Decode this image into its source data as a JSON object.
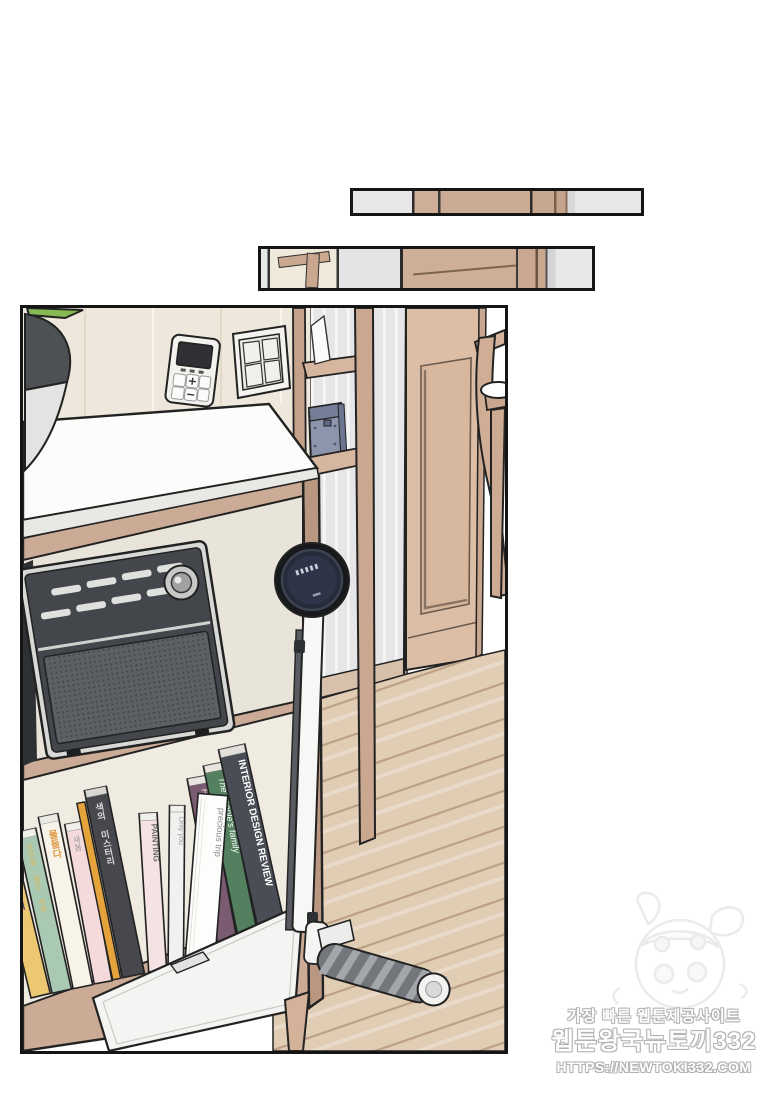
{
  "scene": {
    "type": "webtoon-episode-panel",
    "panel_count": 3,
    "objects": [
      "plant-pot",
      "thermostat",
      "light-switch",
      "white-countertop",
      "wood-cabinet",
      "vintage-radio",
      "book-row",
      "drawer",
      "cabinet-leg",
      "cordless-stick-vacuum",
      "ladder-shelf",
      "blue-toolbox",
      "paneled-wall",
      "wooden-door",
      "wooden-chair",
      "wood-plank-floor"
    ]
  },
  "books": [
    {
      "title": "국어의 정석",
      "spine_color": "#ecc873",
      "text_color": "#43436b"
    },
    {
      "title": "모두를 품은 하루",
      "spine_color": "#a9c9b3",
      "text_color": "#dcb85e"
    },
    {
      "title": "물들다",
      "spine_color": "#f7f3e9",
      "text_color": "#e09a46"
    },
    {
      "title": "새봄",
      "spine_color": "#f4dadb",
      "text_color": "#9a9aa0"
    },
    {
      "title": "색의 미스터리",
      "spine_color": "#46484e",
      "text_color": "#d9d9d9"
    },
    {
      "title": "PAINTING",
      "spine_color": "#f5e3e3",
      "text_color": "#6b6b6b"
    },
    {
      "title": "Only you",
      "spine_color": "#f1f1ef",
      "text_color": "#9a9a9a"
    },
    {
      "title": "precious trip",
      "spine_color": "#fdfdfc",
      "text_color": "#8a8a8a"
    },
    {
      "title": "Furniture history",
      "spine_color": "#7a5b71",
      "text_color": "#e6cda6"
    },
    {
      "title": "The people's family",
      "spine_color": "#53805f",
      "text_color": "#ece8d6"
    },
    {
      "title": "INTERIOR DESIGN REVIEW",
      "spine_color": "#4a4d55",
      "text_color": "#ffffff"
    }
  ],
  "watermark": {
    "tagline": "가장 빠른 웹툰제공사이트",
    "site_name": "웹툰왕국뉴토끼332",
    "site_url": "HTTPS://NEWTOKI332.COM"
  },
  "palette": {
    "wall_cream": "#ede8db",
    "wall_gray_panels": "#e7e7e9",
    "wood_cabinet": "#cbab95",
    "wood_floor": "#e1ccb4",
    "floor_line": "#bda186",
    "radio_face": "#43464b",
    "radio_grille": "#5c5f63",
    "vacuum_dark": "#2e3448",
    "toolbox_blue": "#8d95ac",
    "panel_border": "#151515"
  }
}
